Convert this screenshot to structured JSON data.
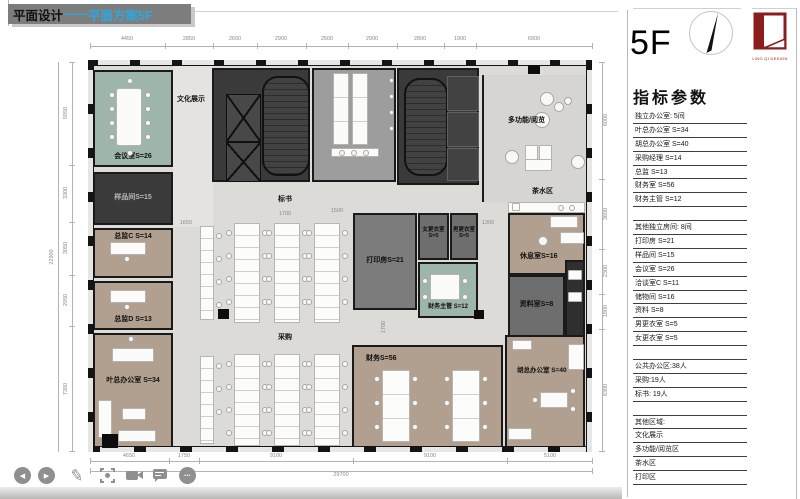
{
  "title": {
    "prefix": "平面设计",
    "dash": "——",
    "highlight": "平面方案5F"
  },
  "floor_badge": "5F",
  "logo": {
    "text": "LING QI DESIGN"
  },
  "panel": {
    "heading": "指标参数",
    "rows": [
      "独立办公室: 5间",
      "叶总办公室 S=34",
      "胡总办公室 S=40",
      "采购经理 S=14",
      "总监 S=13",
      "财务室 S=56",
      "财务主管 S=12",
      "",
      "其他独立房间: 8间",
      "打印房 S=21",
      "样品间 S=15",
      "会议室 S=26",
      "洽谈室C S=11",
      "储物间 S=16",
      "资料 S=8",
      "男更衣室  S=5",
      "女更衣室  S=5",
      "",
      "公共办公区:38人",
      "采购:19人",
      "标书: 19人",
      "",
      "其他区域:",
      "文化展示",
      "多功能/阅览区",
      "茶水区",
      "打印区"
    ]
  },
  "plan": {
    "labels": {
      "culture": "文化展示",
      "meeting": "会议室S=26",
      "sample": "样品间S=15",
      "directorC": "总监C S=14",
      "directorD": "总监D S=13",
      "yeOffice": "叶总办公室 S=34",
      "bidDocs": "标书",
      "procurement": "采购",
      "multi": "多功能/阅览",
      "tea": "茶水区",
      "print": "打印房S=21",
      "women1": "女更衣室",
      "women2": "S=5",
      "men1": "男更衣室",
      "men2": "S=5",
      "finSupervisor": "财务主管  S=12",
      "rest": "休息室S=16",
      "archive": "资料室S=8",
      "finance": "财务S=56",
      "huOffice": "胡总办公室  S=40"
    },
    "dims": {
      "top": [
        "4450",
        "2850",
        "2600",
        "2900",
        "2500",
        "2900",
        "2800",
        "1900",
        "6900"
      ],
      "left": [
        "5950",
        "3300",
        "3050",
        "2950",
        "7350"
      ],
      "left_total": "22900",
      "right": [
        "6000",
        "3600",
        "2300",
        "1800",
        "6300"
      ],
      "bottom": [
        "4650",
        "1750",
        "9100",
        "9100",
        "5100"
      ],
      "bottom_total": "29700",
      "inner": [
        "1650",
        "1700",
        "1500",
        "1300",
        "1700"
      ]
    }
  },
  "toolbar": {
    "icons": [
      "previous",
      "next",
      "pen",
      "laser-pointer",
      "camera",
      "comment",
      "more"
    ],
    "more_glyph": "•••",
    "prev_glyph": "◀",
    "next_glyph": "▶",
    "pen_glyph": "✎"
  }
}
